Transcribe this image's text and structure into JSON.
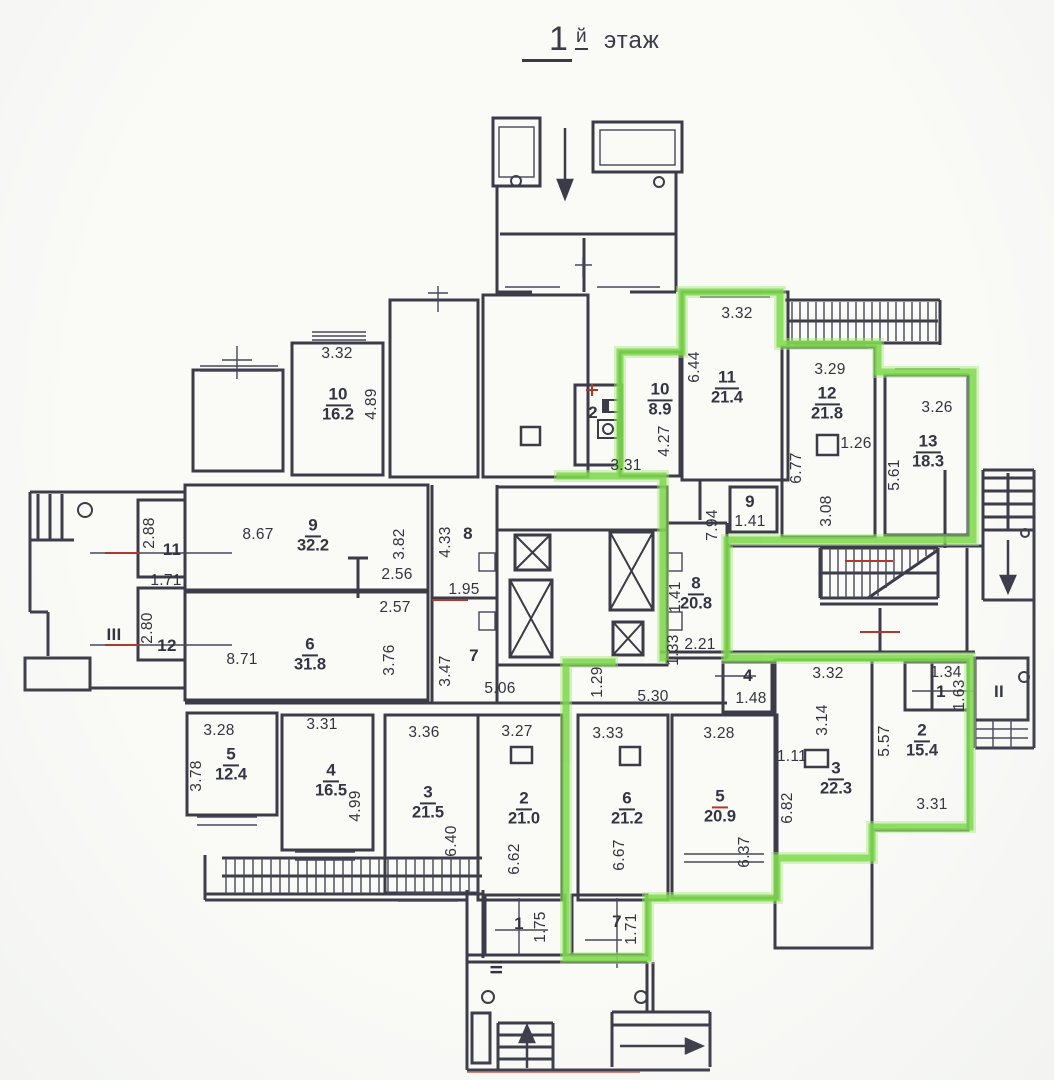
{
  "title": {
    "number": "1",
    "suffix": "й",
    "word": "этаж"
  },
  "colors": {
    "highlight_green": "#7cd84a",
    "ink": "#3c3c48",
    "red_mark": "#b0392e"
  },
  "room_labels": [
    {
      "number": "10",
      "area": "16.2",
      "x": 338,
      "y": 405
    },
    {
      "number": "10",
      "area": "8.9",
      "x": 660,
      "y": 400
    },
    {
      "number": "11",
      "area": "21.4",
      "x": 727,
      "y": 388
    },
    {
      "number": "12",
      "area": "21.8",
      "x": 827,
      "y": 404
    },
    {
      "number": "13",
      "area": "18.3",
      "x": 928,
      "y": 452
    },
    {
      "number": "9",
      "area": "32.2",
      "x": 313,
      "y": 536
    },
    {
      "number": "6",
      "area": "31.8",
      "x": 310,
      "y": 655
    },
    {
      "number": "8",
      "area": "20.8",
      "x": 696,
      "y": 594
    },
    {
      "number": "3",
      "area": "22.3",
      "x": 836,
      "y": 779
    },
    {
      "number": "2",
      "area": "15.4",
      "x": 922,
      "y": 741
    },
    {
      "number": "5",
      "area": "12.4",
      "x": 231,
      "y": 765
    },
    {
      "number": "4",
      "area": "16.5",
      "x": 331,
      "y": 781
    },
    {
      "number": "3",
      "area": "21.5",
      "x": 428,
      "y": 803
    },
    {
      "number": "2",
      "area": "21.0",
      "x": 524,
      "y": 809
    },
    {
      "number": "6",
      "area": "21.2",
      "x": 627,
      "y": 809
    },
    {
      "number": "5",
      "area": "20.9",
      "x": 720,
      "y": 807,
      "red_divider": true
    }
  ],
  "dimensions": [
    {
      "t": "3.32",
      "x": 337,
      "y": 354
    },
    {
      "t": "4.89",
      "x": 372,
      "y": 404,
      "r": 1
    },
    {
      "t": "3.31",
      "x": 626,
      "y": 466
    },
    {
      "t": "4.27",
      "x": 665,
      "y": 441,
      "r": 1
    },
    {
      "t": "6.44",
      "x": 695,
      "y": 367,
      "r": 1
    },
    {
      "t": "3.32",
      "x": 737,
      "y": 314
    },
    {
      "t": "3.29",
      "x": 830,
      "y": 370
    },
    {
      "t": "1.26",
      "x": 856,
      "y": 444
    },
    {
      "t": "6.77",
      "x": 797,
      "y": 468,
      "r": 1
    },
    {
      "t": "3.08",
      "x": 827,
      "y": 511,
      "r": 1
    },
    {
      "t": "3.26",
      "x": 937,
      "y": 408
    },
    {
      "t": "5.61",
      "x": 895,
      "y": 475,
      "r": 1
    },
    {
      "t": "2.88",
      "x": 150,
      "y": 533,
      "r": 1
    },
    {
      "t": "1.71",
      "x": 166,
      "y": 581
    },
    {
      "t": "2.80",
      "x": 148,
      "y": 628,
      "r": 1
    },
    {
      "t": "8.67",
      "x": 258,
      "y": 535
    },
    {
      "t": "3.82",
      "x": 400,
      "y": 544,
      "r": 1
    },
    {
      "t": "2.56",
      "x": 397,
      "y": 575
    },
    {
      "t": "2.57",
      "x": 395,
      "y": 608
    },
    {
      "t": "3.76",
      "x": 390,
      "y": 660,
      "r": 1
    },
    {
      "t": "8.71",
      "x": 242,
      "y": 660
    },
    {
      "t": "4.33",
      "x": 446,
      "y": 542,
      "r": 1
    },
    {
      "t": "1.95",
      "x": 464,
      "y": 590
    },
    {
      "t": "3.47",
      "x": 446,
      "y": 671,
      "r": 1
    },
    {
      "t": "5.06",
      "x": 500,
      "y": 689
    },
    {
      "t": "7.94",
      "x": 713,
      "y": 525,
      "r": 1
    },
    {
      "t": "1.41",
      "x": 750,
      "y": 522
    },
    {
      "t": "1.41",
      "x": 676,
      "y": 597,
      "r": 1
    },
    {
      "t": "1.33",
      "x": 674,
      "y": 650,
      "r": 1
    },
    {
      "t": "2.21",
      "x": 700,
      "y": 645
    },
    {
      "t": "1.29",
      "x": 598,
      "y": 682,
      "r": 1
    },
    {
      "t": "5.30",
      "x": 653,
      "y": 697
    },
    {
      "t": "1.48",
      "x": 751,
      "y": 699
    },
    {
      "t": "3.32",
      "x": 828,
      "y": 674
    },
    {
      "t": "3.14",
      "x": 823,
      "y": 720,
      "r": 1
    },
    {
      "t": "1.11",
      "x": 792,
      "y": 757
    },
    {
      "t": "6.82",
      "x": 788,
      "y": 808,
      "r": 1
    },
    {
      "t": "5.57",
      "x": 885,
      "y": 741,
      "r": 1
    },
    {
      "t": "3.31",
      "x": 932,
      "y": 805
    },
    {
      "t": "1.34",
      "x": 946,
      "y": 673
    },
    {
      "t": "1.63",
      "x": 960,
      "y": 695,
      "r": 1
    },
    {
      "t": "3.28",
      "x": 219,
      "y": 731
    },
    {
      "t": "3.78",
      "x": 197,
      "y": 776,
      "r": 1
    },
    {
      "t": "3.31",
      "x": 322,
      "y": 725
    },
    {
      "t": "4.99",
      "x": 356,
      "y": 806,
      "r": 1
    },
    {
      "t": "3.36",
      "x": 424,
      "y": 733
    },
    {
      "t": "6.40",
      "x": 452,
      "y": 841,
      "r": 1
    },
    {
      "t": "3.27",
      "x": 517,
      "y": 732
    },
    {
      "t": "6.62",
      "x": 515,
      "y": 859,
      "r": 1
    },
    {
      "t": "3.33",
      "x": 608,
      "y": 734
    },
    {
      "t": "6.67",
      "x": 620,
      "y": 855,
      "r": 1
    },
    {
      "t": "3.28",
      "x": 719,
      "y": 734
    },
    {
      "t": "6.37",
      "x": 745,
      "y": 852,
      "r": 1
    },
    {
      "t": "1.75",
      "x": 541,
      "y": 927,
      "r": 1
    },
    {
      "t": "1.71",
      "x": 632,
      "y": 929,
      "r": 1
    }
  ],
  "plain_labels": [
    {
      "t": "2",
      "x": 593,
      "y": 413
    },
    {
      "t": "8",
      "x": 468,
      "y": 534
    },
    {
      "t": "7",
      "x": 474,
      "y": 656
    },
    {
      "t": "9",
      "x": 750,
      "y": 502
    },
    {
      "t": "4",
      "x": 748,
      "y": 676
    },
    {
      "t": "1",
      "x": 941,
      "y": 692
    },
    {
      "t": "11",
      "x": 172,
      "y": 550
    },
    {
      "t": "12",
      "x": 167,
      "y": 646
    },
    {
      "t": "III",
      "x": 114,
      "y": 635
    },
    {
      "t": "II",
      "x": 999,
      "y": 692
    },
    {
      "t": "1",
      "x": 519,
      "y": 924
    },
    {
      "t": "7",
      "x": 617,
      "y": 922
    },
    {
      "t": "III",
      "x": 497,
      "y": 967,
      "r": 1
    }
  ]
}
